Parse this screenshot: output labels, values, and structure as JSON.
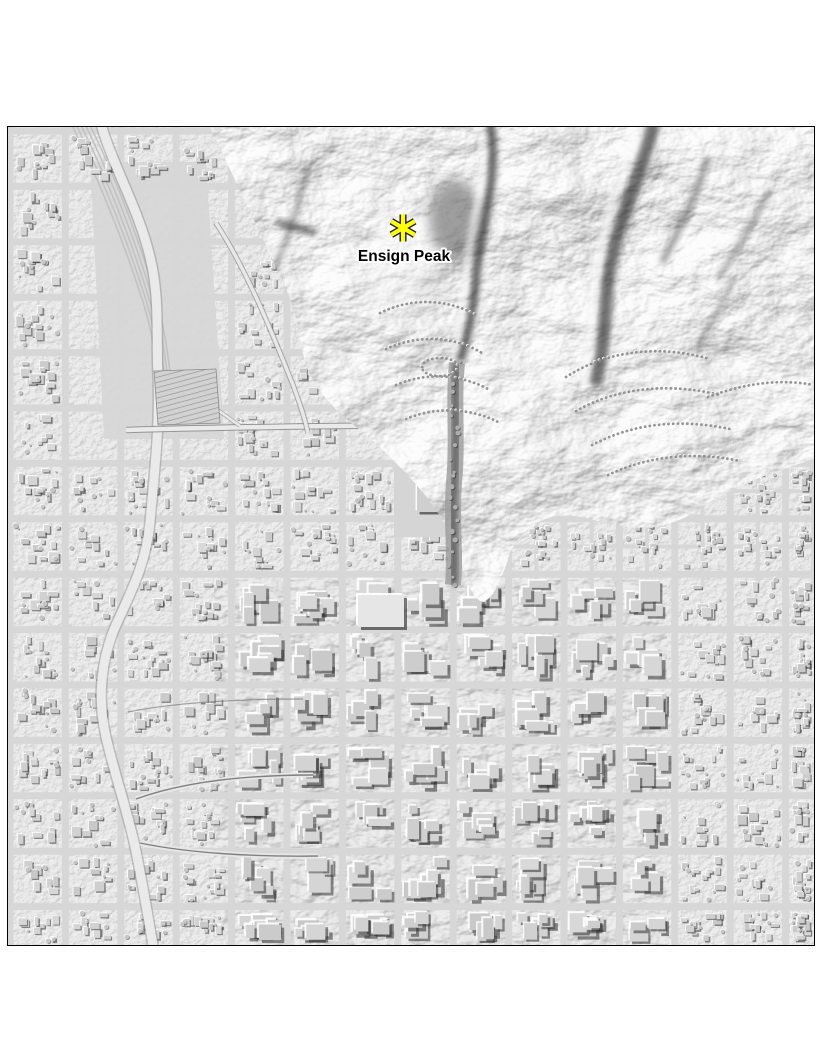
{
  "page": {
    "background_color": "#ffffff"
  },
  "map": {
    "base_color": "#d8d8d8",
    "street_color": "#d7d7d7",
    "border_color": "#000000",
    "marker": {
      "symbol": "asterisk",
      "fill": "#ffff00",
      "outline": "#1c1c1c"
    },
    "label": {
      "text": "Ensign Peak",
      "color": "#000000",
      "halo_color": "#ffffff"
    }
  }
}
